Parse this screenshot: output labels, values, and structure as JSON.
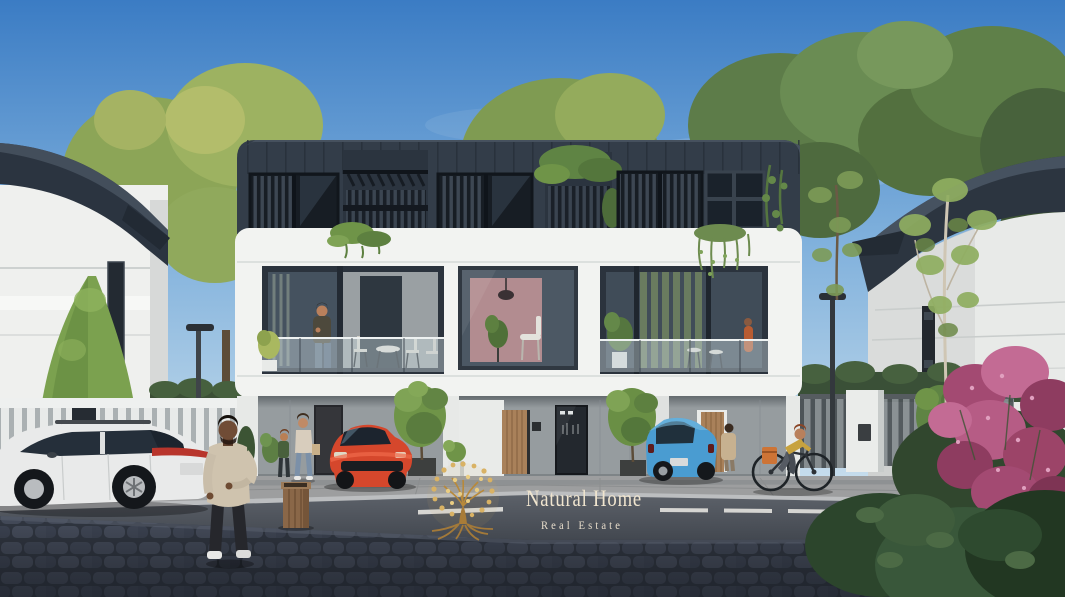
{
  "scene": {
    "type": "architectural-render",
    "subject": "modern townhouse complex street view",
    "watermark": {
      "title": "Natural Home",
      "subtitle": "Real Estate"
    }
  },
  "palette": {
    "sky_top": "#3b7cc4",
    "sky_mid": "#7fb0dc",
    "sky_horizon": "#d6e6f0",
    "dark_cladding": "#333d49",
    "white_facade": "#f2f3f1",
    "ground_floor_wall": "#969c9f",
    "wood_door": "#a9815a",
    "gold_logo": "#c9a24c",
    "watermark_text": "#f0e5cf",
    "red_car": "#d5472c",
    "blue_car": "#4a9cd1",
    "white_car": "#e9eaea",
    "road": "#4d525a",
    "cobblestone": "#3a404c",
    "sidewalk": "#a0a1a2",
    "foliage_green": "#7c9c52",
    "foliage_dark": "#4c6840",
    "pink_flowers": "#b65c85"
  }
}
